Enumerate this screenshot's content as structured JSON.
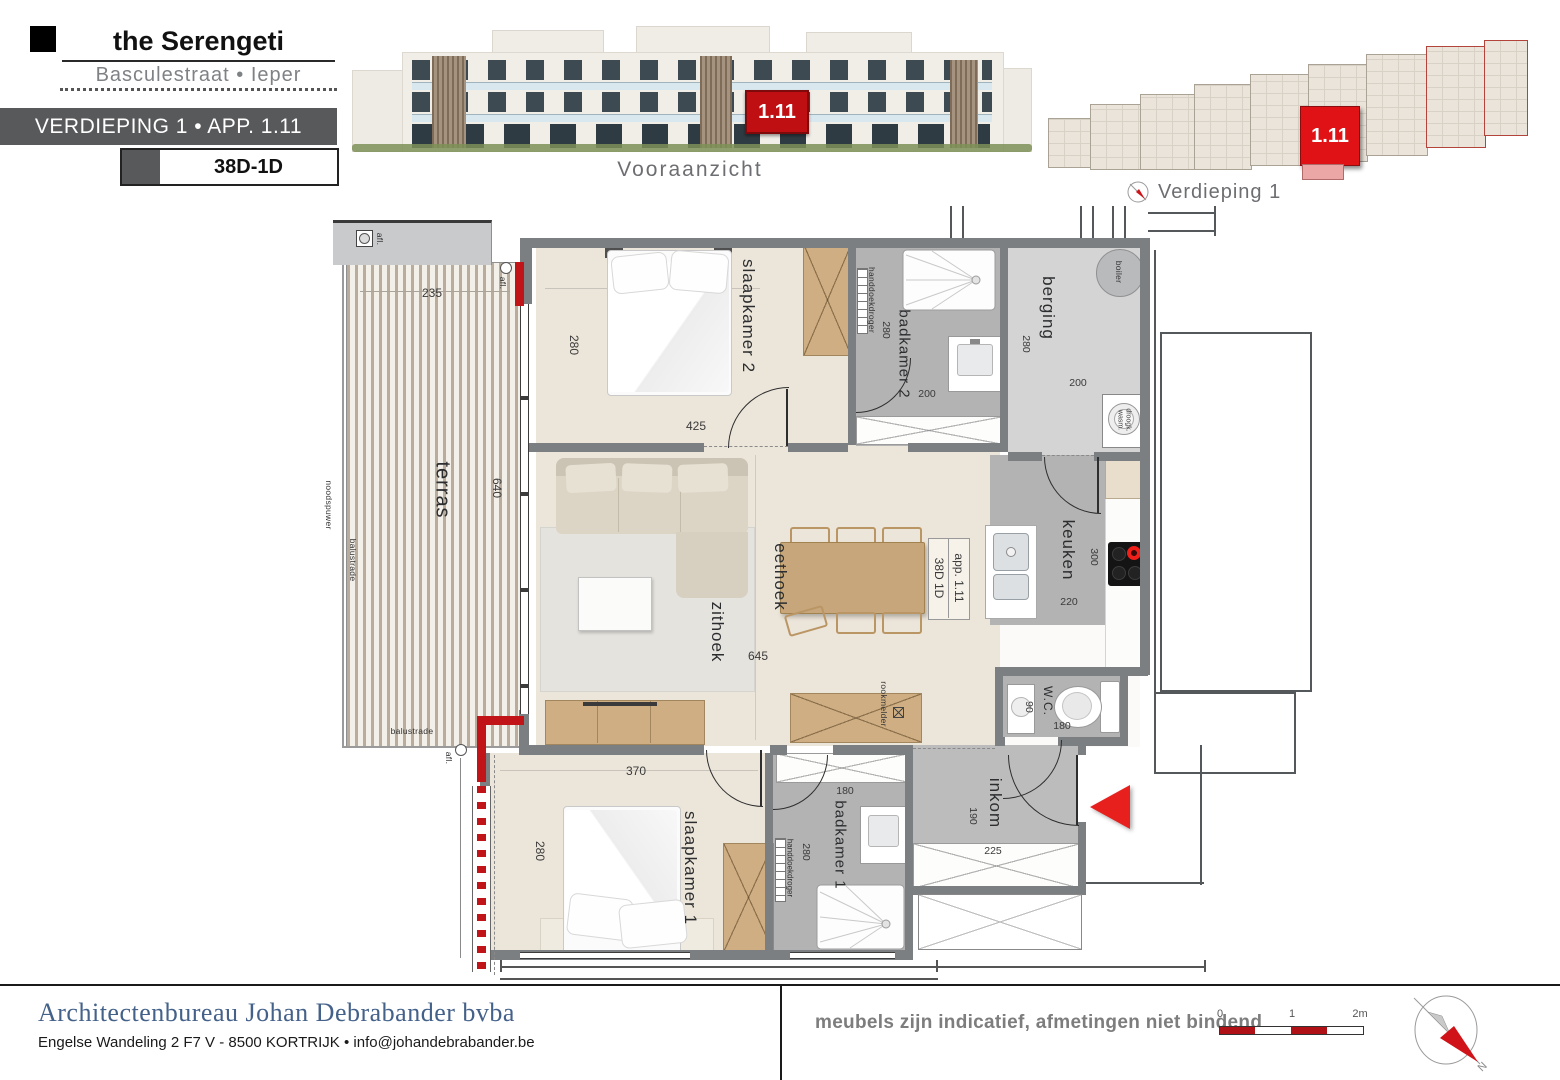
{
  "header": {
    "title": "the Serengeti",
    "subtitle": "Basculestraat • Ieper",
    "floor_bar": "VERDIEPING 1   •   APP. 1.11",
    "unit_code": "38D-1D"
  },
  "elevation": {
    "caption": "Vooraanzicht",
    "unit_badge": "1.11"
  },
  "overview": {
    "caption": "Verdieping 1",
    "unit_badge": "1.11"
  },
  "plan": {
    "rooms": {
      "terras": "terras",
      "slaapkamer2": "slaapkamer 2",
      "badkamer2": "badkamer 2",
      "berging": "berging",
      "zithoek": "zithoek",
      "eethoek": "eethoek",
      "keuken": "keuken",
      "wc": "W.C.",
      "inkom": "inkom",
      "slaapkamer1": "slaapkamer 1",
      "badkamer1": "badkamer 1"
    },
    "dims": {
      "terras": {
        "w": "235",
        "h": "640"
      },
      "slaapkamer2": {
        "h": "280",
        "w": "425"
      },
      "badkamer2": {
        "h": "280",
        "w": "200"
      },
      "berging": {
        "h": "280",
        "w": "200"
      },
      "living": {
        "w": "645"
      },
      "keuken": {
        "h": "300",
        "w": "220"
      },
      "wc": {
        "h": "90",
        "w": "180"
      },
      "inkom": {
        "h": "190",
        "w": "225"
      },
      "slaapkamer1": {
        "w": "370",
        "h": "280"
      },
      "badkamer1": {
        "w": "180",
        "h": "280"
      }
    },
    "annotations": {
      "app_label": "app. 1.11",
      "unit_label": "38D 1D",
      "balustrade": "balustrade",
      "noodspuwer": "noodspuwer",
      "afl": "afl.",
      "boiler": "boiler",
      "washer_line1": "wasm.",
      "washer_line2": "droogk.",
      "handdoekdroger": "handdoekdroger",
      "rookmelder": "rookmelder"
    }
  },
  "footer": {
    "firm_name": "Architectenbureau Johan Debrabander bvba",
    "firm_address": "Engelse Wandeling 2 F7 V - 8500 KORTRIJK  •  info@johandebrabander.be",
    "disclaimer": "meubels zijn indicatief, afmetingen niet bindend",
    "scale_ticks": [
      "0",
      "1",
      "2m"
    ],
    "compass_label": "N"
  },
  "colors": {
    "accent_red": "#c01418",
    "wall_gray": "#7c7f82",
    "floor_beige": "#ece5da",
    "bath_gray": "#b3b3b3",
    "wood": "#cfae83",
    "footer_blue": "#44618a",
    "bar_gray": "#58595b"
  }
}
